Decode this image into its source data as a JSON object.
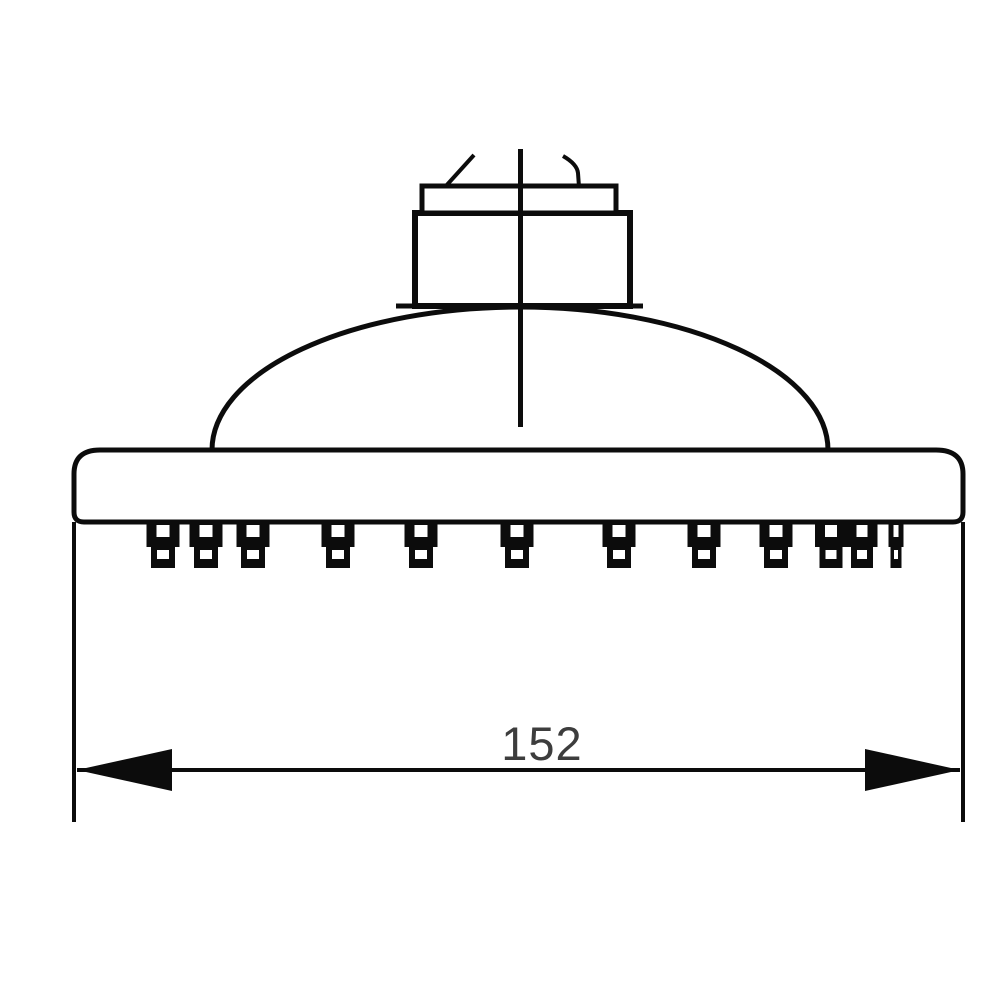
{
  "diagram": {
    "type": "technical-drawing",
    "subject": "shower-head-side-elevation",
    "dimension": {
      "label": "152",
      "position": "bottom-center-above-dimension-line"
    },
    "colors": {
      "line": "#0c0c0c",
      "dimension_text": "#3d3d3d",
      "background": "#ffffff"
    },
    "geometry": {
      "head_plate": {
        "left": 74,
        "right": 963,
        "top": 450,
        "bottom": 522
      },
      "dome": {
        "left": 212,
        "right": 828,
        "base_y": 450,
        "peak_y": 306
      },
      "nut": {
        "left": 415,
        "right": 630,
        "top": 213,
        "bottom": 306
      },
      "collar": {
        "left": 422,
        "right": 616,
        "top": 186,
        "bottom": 213
      },
      "centerline": {
        "x": 520,
        "top": 149,
        "bottom": 427
      },
      "dimension_line_y": 770,
      "extension_line_bottom": 822
    },
    "nozzles": [
      {
        "x": 163,
        "w": 33
      },
      {
        "x": 206,
        "w": 33
      },
      {
        "x": 253,
        "w": 33
      },
      {
        "x": 338,
        "w": 33
      },
      {
        "x": 421,
        "w": 33
      },
      {
        "x": 517,
        "w": 33
      },
      {
        "x": 619,
        "w": 33
      },
      {
        "x": 704,
        "w": 33
      },
      {
        "x": 776,
        "w": 33
      },
      {
        "x": 831,
        "w": 32
      },
      {
        "x": 862,
        "w": 31
      },
      {
        "x": 896,
        "w": 15
      }
    ]
  }
}
